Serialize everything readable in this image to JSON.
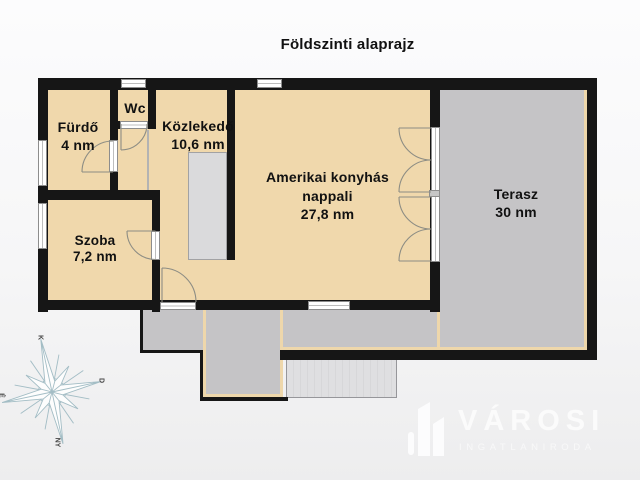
{
  "title": "Földszinti alaprajz",
  "rooms": {
    "furdo": {
      "name": "Fürdő",
      "area": "4 nm"
    },
    "wc": {
      "name": "Wc"
    },
    "kozlekedo": {
      "name": "Közlekedő",
      "area": "10,6 nm"
    },
    "nappali": {
      "name_line1": "Amerikai konyhás",
      "name_line2": "nappali",
      "area": "27,8 nm"
    },
    "szoba": {
      "name": "Szoba",
      "area": "7,2 nm"
    },
    "terasz": {
      "name": "Terasz",
      "area": "30 nm"
    }
  },
  "compass": {
    "north": "É",
    "east": "K",
    "south": "D",
    "west": "NY"
  },
  "logo": {
    "brand": "VÁROSI",
    "tagline": "INGATLANIRODA"
  },
  "colors": {
    "room_fill": "#f0d8ac",
    "paved_fill": "#c5c4c6",
    "wall": "#161616",
    "stairs_fill": "#dadadc",
    "beige_outline": "#eed7ab",
    "compass_stroke": "#a3bdc5",
    "logo_color": "#fbfbfb"
  }
}
